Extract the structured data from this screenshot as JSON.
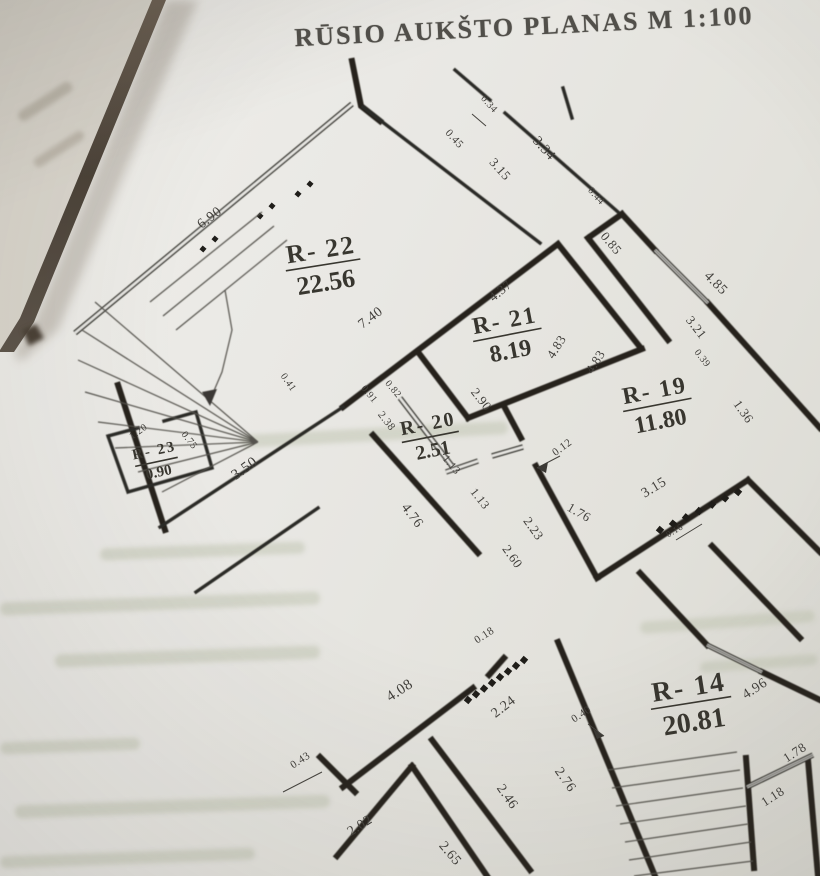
{
  "page": {
    "title": "RŪSIO AUKŠTO PLANAS M 1:100"
  },
  "plan": {
    "rooms": [
      {
        "id": "R- 22",
        "area": "22.56",
        "x": 322,
        "y": 258,
        "rot": -9,
        "size": 26
      },
      {
        "id": "R- 21",
        "area": "8.19",
        "x": 506,
        "y": 328,
        "rot": -11,
        "size": 24
      },
      {
        "id": "R- 19",
        "area": "11.80",
        "x": 656,
        "y": 398,
        "rot": -11,
        "size": 24
      },
      {
        "id": "R- 20",
        "area": "2.51",
        "x": 429,
        "y": 430,
        "rot": -11,
        "size": 20
      },
      {
        "id": "R- 23",
        "area": "0.90",
        "x": 155,
        "y": 455,
        "rot": -12,
        "size": 15
      },
      {
        "id": "R- 14",
        "area": "20.81",
        "x": 690,
        "y": 696,
        "rot": -9,
        "size": 28
      }
    ],
    "dimensions": [
      {
        "t": "6.90",
        "x": 212,
        "y": 221,
        "r": -37,
        "s": 14
      },
      {
        "t": "0.34",
        "x": 487,
        "y": 106,
        "r": 48,
        "s": 10
      },
      {
        "t": "0.45",
        "x": 452,
        "y": 141,
        "r": 48,
        "s": 11
      },
      {
        "t": "3.34",
        "x": 541,
        "y": 151,
        "r": 48,
        "s": 14
      },
      {
        "t": "3.15",
        "x": 497,
        "y": 172,
        "r": 48,
        "s": 13
      },
      {
        "t": "0.44",
        "x": 594,
        "y": 198,
        "r": 48,
        "s": 10
      },
      {
        "t": "0.85",
        "x": 608,
        "y": 246,
        "r": 50,
        "s": 13
      },
      {
        "t": "4.85",
        "x": 713,
        "y": 286,
        "r": 45,
        "s": 14
      },
      {
        "t": "3.21",
        "x": 693,
        "y": 330,
        "r": 52,
        "s": 13
      },
      {
        "t": "0.39",
        "x": 700,
        "y": 360,
        "r": 52,
        "s": 10
      },
      {
        "t": "1.36",
        "x": 740,
        "y": 414,
        "r": 55,
        "s": 13
      },
      {
        "t": "7.40",
        "x": 373,
        "y": 321,
        "r": -37,
        "s": 14
      },
      {
        "t": "4.37",
        "x": 503,
        "y": 294,
        "r": -40,
        "s": 13
      },
      {
        "t": "4.83",
        "x": 560,
        "y": 349,
        "r": -58,
        "s": 13
      },
      {
        "t": "4.83",
        "x": 599,
        "y": 364,
        "r": -58,
        "s": 13
      },
      {
        "t": "2.90",
        "x": 478,
        "y": 402,
        "r": 52,
        "s": 13
      },
      {
        "t": "0.91",
        "x": 367,
        "y": 396,
        "r": 50,
        "s": 10
      },
      {
        "t": "0.82",
        "x": 391,
        "y": 391,
        "r": 50,
        "s": 10
      },
      {
        "t": "2.38",
        "x": 384,
        "y": 423,
        "r": 52,
        "s": 11
      },
      {
        "t": "1.13",
        "x": 449,
        "y": 467,
        "r": 50,
        "s": 11
      },
      {
        "t": "1.13",
        "x": 477,
        "y": 501,
        "r": 52,
        "s": 12
      },
      {
        "t": "4.76",
        "x": 409,
        "y": 518,
        "r": 53,
        "s": 14
      },
      {
        "t": "3.50",
        "x": 247,
        "y": 472,
        "r": -36,
        "s": 15
      },
      {
        "t": "1.20",
        "x": 140,
        "y": 434,
        "r": -36,
        "s": 10
      },
      {
        "t": "0.75",
        "x": 187,
        "y": 442,
        "r": 52,
        "s": 10
      },
      {
        "t": "0.41",
        "x": 286,
        "y": 384,
        "r": 55,
        "s": 10
      },
      {
        "t": "0.12",
        "x": 564,
        "y": 450,
        "r": -36,
        "s": 11
      },
      {
        "t": "1.76",
        "x": 577,
        "y": 516,
        "r": 30,
        "s": 13
      },
      {
        "t": "3.15",
        "x": 656,
        "y": 491,
        "r": -31,
        "s": 14
      },
      {
        "t": "0.16",
        "x": 676,
        "y": 533,
        "r": -31,
        "s": 9
      },
      {
        "t": "2.23",
        "x": 530,
        "y": 531,
        "r": 55,
        "s": 13
      },
      {
        "t": "2.60",
        "x": 509,
        "y": 559,
        "r": 55,
        "s": 13
      },
      {
        "t": "4.08",
        "x": 402,
        "y": 694,
        "r": -33,
        "s": 15
      },
      {
        "t": "0.18",
        "x": 486,
        "y": 638,
        "r": -33,
        "s": 11
      },
      {
        "t": "2.24",
        "x": 506,
        "y": 710,
        "r": -38,
        "s": 14
      },
      {
        "t": "0.43",
        "x": 302,
        "y": 763,
        "r": -33,
        "s": 11
      },
      {
        "t": "2.02",
        "x": 362,
        "y": 829,
        "r": -33,
        "s": 14
      },
      {
        "t": "2.65",
        "x": 447,
        "y": 856,
        "r": 50,
        "s": 14
      },
      {
        "t": "2.46",
        "x": 504,
        "y": 799,
        "r": 55,
        "s": 14
      },
      {
        "t": "2.76",
        "x": 562,
        "y": 782,
        "r": 55,
        "s": 14
      },
      {
        "t": "0.40",
        "x": 583,
        "y": 717,
        "r": -33,
        "s": 11
      },
      {
        "t": "4.96",
        "x": 757,
        "y": 692,
        "r": -33,
        "s": 14
      },
      {
        "t": "1.78",
        "x": 797,
        "y": 756,
        "r": -33,
        "s": 13
      },
      {
        "t": "1.18",
        "x": 775,
        "y": 800,
        "r": -33,
        "s": 13
      }
    ]
  }
}
